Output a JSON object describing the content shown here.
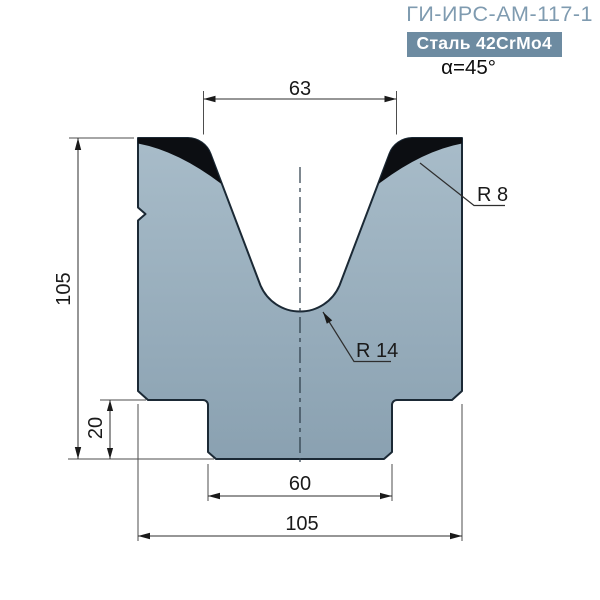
{
  "header": {
    "title": "ГИ-ИРС-АМ-117-1",
    "material_badge": "Сталь 42CrMo4",
    "angle_label": "α=45°"
  },
  "drawing": {
    "labels": {
      "opening_width": "63",
      "die_height": "105",
      "tang_height": "20",
      "tang_width": "60",
      "die_width": "105",
      "shoulder_radius": "R 8",
      "groove_radius": "R 14"
    },
    "colors": {
      "body_fill_top": "#a8bcc9",
      "body_fill_bottom": "#8aa1b1",
      "hardened_zone": "#0c0e12",
      "outline": "#1b2935",
      "title_accent": "#7f9bb0",
      "badge_background": "#6d8ba1",
      "badge_text": "#ffffff"
    }
  }
}
